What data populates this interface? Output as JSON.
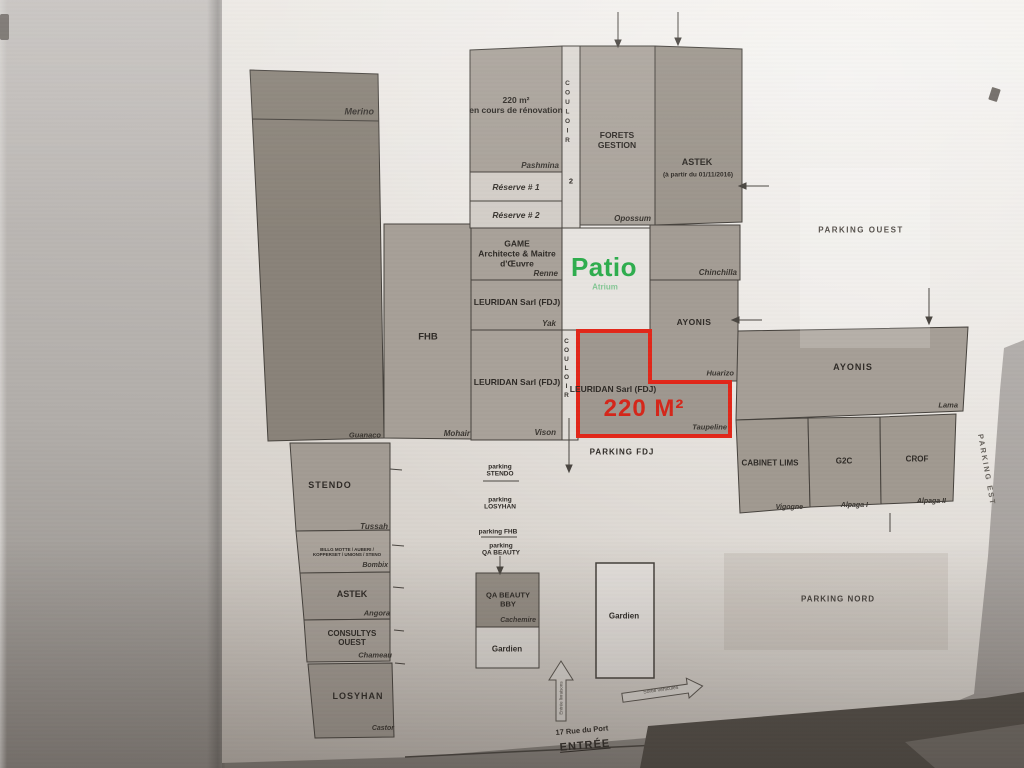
{
  "colors": {
    "highlight_red": "#e2271a",
    "patio_green": "#2fae4e"
  },
  "rooms": {
    "merino": {
      "corner": "Merino",
      "bottom": "Guanaco"
    },
    "renovation": {
      "l1": "220 m²",
      "l2": "en cours de rénovation",
      "corner": "Pashmina"
    },
    "reserve1": {
      "label": "Réserve # 1"
    },
    "reserve2": {
      "label": "Réserve # 2"
    },
    "game": {
      "l1": "GAME",
      "l2": "Architecte & Maitre",
      "l3": "d'Œuvre",
      "corner": "Renne"
    },
    "leuridan1": {
      "label": "LEURIDAN Sarl (FDJ)",
      "corner": "Yak"
    },
    "leuridan2": {
      "label": "LEURIDAN Sarl (FDJ)",
      "corner": "Vison"
    },
    "fhb": {
      "label": "FHB",
      "corner": "Mohair"
    },
    "forets": {
      "l1": "FORETS",
      "l2": "GESTION",
      "corner": "Opossum"
    },
    "astek_top": {
      "label": "ASTEK",
      "sub": "(à partir du 01/11/2016)"
    },
    "chinchilla": {
      "corner": "Chinchilla"
    },
    "ayonis_small": {
      "label": "AYONIS",
      "corner": "Huarizo"
    },
    "ayonis_large": {
      "label": "AYONIS",
      "corner": "Lama"
    },
    "cabinet_lims": {
      "label": "CABINET LIMS",
      "corner": "Vigogne"
    },
    "g2c": {
      "label": "G2C",
      "corner": "Alpaga I"
    },
    "crof": {
      "label": "CROF",
      "corner": "Alpaga II"
    },
    "stendo": {
      "label": "STENDO",
      "corner": "Tussah"
    },
    "shared": {
      "l1": "BILLG MOTTE / AUBERI /",
      "l2": "KOPPERSET / UNIONS / STENO",
      "corner": "Bombix"
    },
    "astek_south": {
      "label": "ASTEK",
      "corner": "Angora"
    },
    "consultys": {
      "l1": "CONSULTYS",
      "l2": "OUEST",
      "corner": "Chameau"
    },
    "losyhan": {
      "label": "LOSYHAN",
      "corner": "Castor"
    },
    "qa_beauty": {
      "l1": "QA BEAUTY",
      "l2": "BBY",
      "corner": "Cachemire"
    },
    "gardien_small": {
      "label": "Gardien"
    },
    "gardien_large": {
      "label": "Gardien"
    }
  },
  "corridors": {
    "couloir2": {
      "letters": "COULOIR",
      "number": "2"
    },
    "couloir": {
      "letters": "COULOIR"
    }
  },
  "patio": {
    "title": "Patio",
    "sub": "Atrium"
  },
  "highlight": {
    "company": "LEURIDAN Sarl (FDJ)",
    "area": "220 M²",
    "corner": "Taupeline"
  },
  "parking": {
    "fdj": "PARKING FDJ",
    "ouest": "PARKING OUEST",
    "nord": "PARKING NORD",
    "est": "PARKING EST",
    "stack": [
      {
        "l1": "parking",
        "l2": "STENDO"
      },
      {
        "l1": "parking",
        "l2": "LOSYHAN"
      },
      {
        "l1": "parking FHB"
      },
      {
        "l1": "parking",
        "l2": "QA BEAUTY"
      }
    ]
  },
  "entrance": {
    "street": "17 Rue du Port",
    "label": "ENTRÉE",
    "up_arrow": "Entrée livraisons",
    "right_arrow": "Sortie véhicules"
  }
}
